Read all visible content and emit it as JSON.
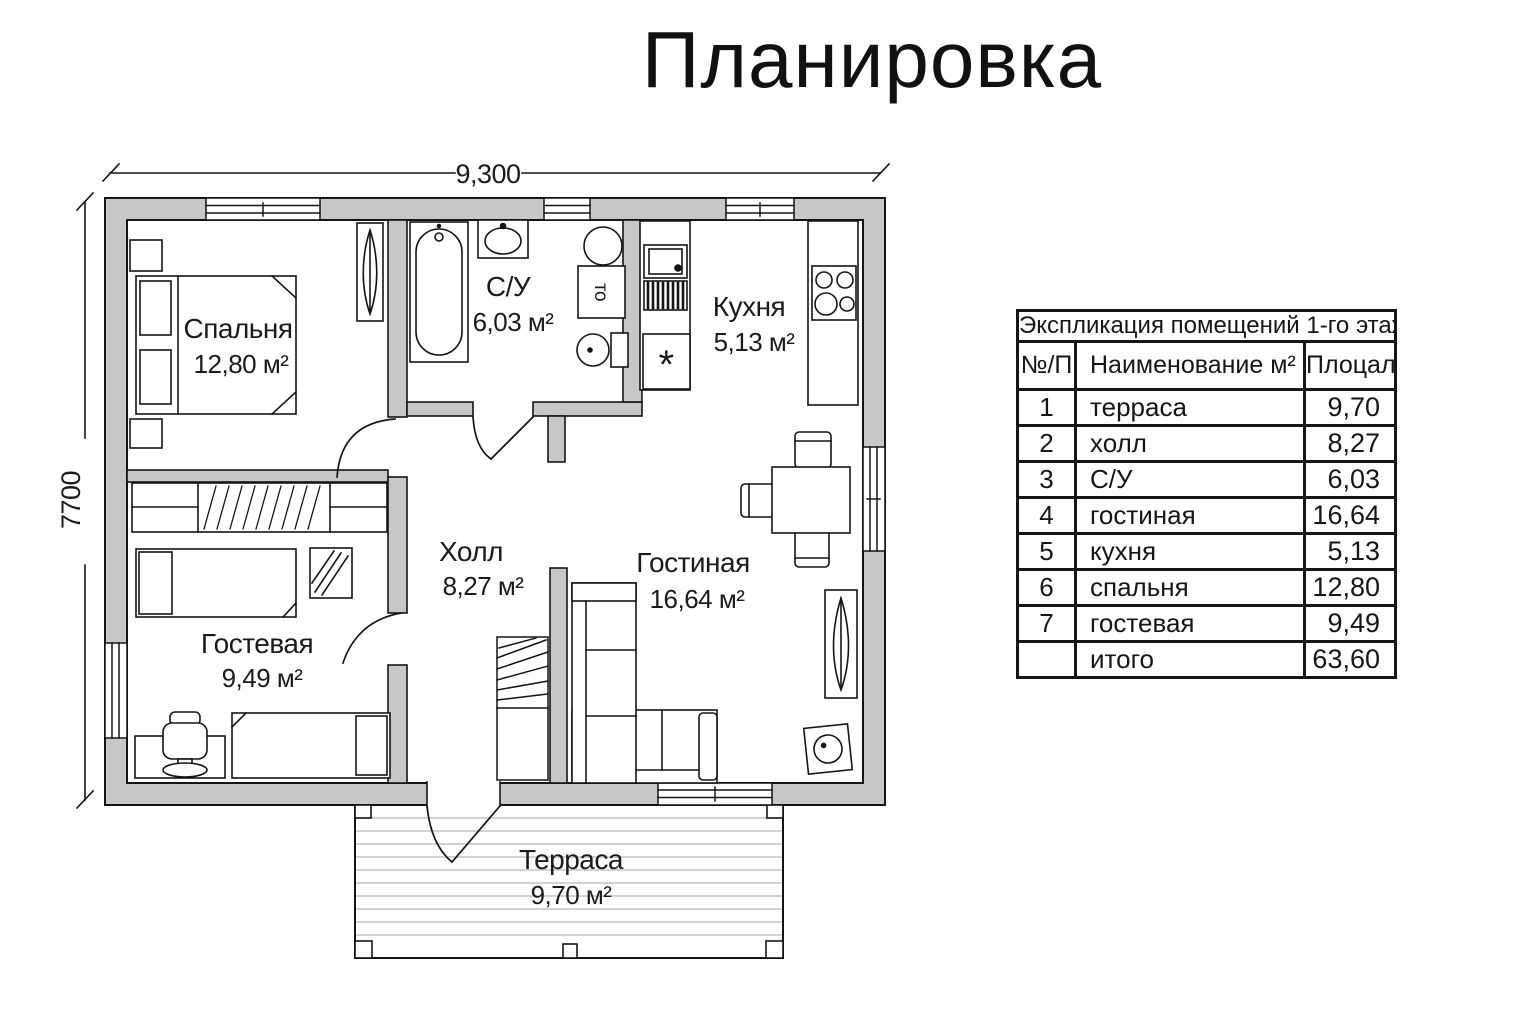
{
  "title": "Планировка",
  "dimensions": {
    "top": "9,300",
    "left": "7700"
  },
  "rooms": {
    "bedroom": {
      "name": "Спальня",
      "area": "12,80 м²"
    },
    "bathroom": {
      "name": "С/У",
      "area": "6,03 м²"
    },
    "kitchen": {
      "name": "Кухня",
      "area": "5,13 м²"
    },
    "hall": {
      "name": "Холл",
      "area": "8,27 м²"
    },
    "living": {
      "name": "Гостиная",
      "area": "16,64 м²"
    },
    "guest": {
      "name": "Гостевая",
      "area": "9,49 м²"
    },
    "terrace": {
      "name": "Терраса",
      "area": "9,70 м²"
    }
  },
  "fixtures": {
    "washer_label": "то",
    "freezer_label": "*"
  },
  "table": {
    "title": "Экспликация помещений 1-го этажа",
    "columns": [
      "№/П",
      "Наименование   м²",
      "Плоцаль"
    ],
    "rows": [
      {
        "num": "1",
        "name": "терраса",
        "area": "9,70"
      },
      {
        "num": "2",
        "name": "холл",
        "area": "8,27"
      },
      {
        "num": "3",
        "name": "С/У",
        "area": "6,03"
      },
      {
        "num": "4",
        "name": "гостиная",
        "area": "16,64"
      },
      {
        "num": "5",
        "name": "кухня",
        "area": "5,13"
      },
      {
        "num": "6",
        "name": "спальня",
        "area": "12,80"
      },
      {
        "num": "7",
        "name": "гостевая",
        "area": "9,49"
      },
      {
        "num": "",
        "name": "итого",
        "area": "63,60"
      }
    ]
  },
  "colors": {
    "wall_fill": "#c7c7c7",
    "line": "#151515",
    "deck_line": "#c3c3c3",
    "bg": "#ffffff"
  }
}
